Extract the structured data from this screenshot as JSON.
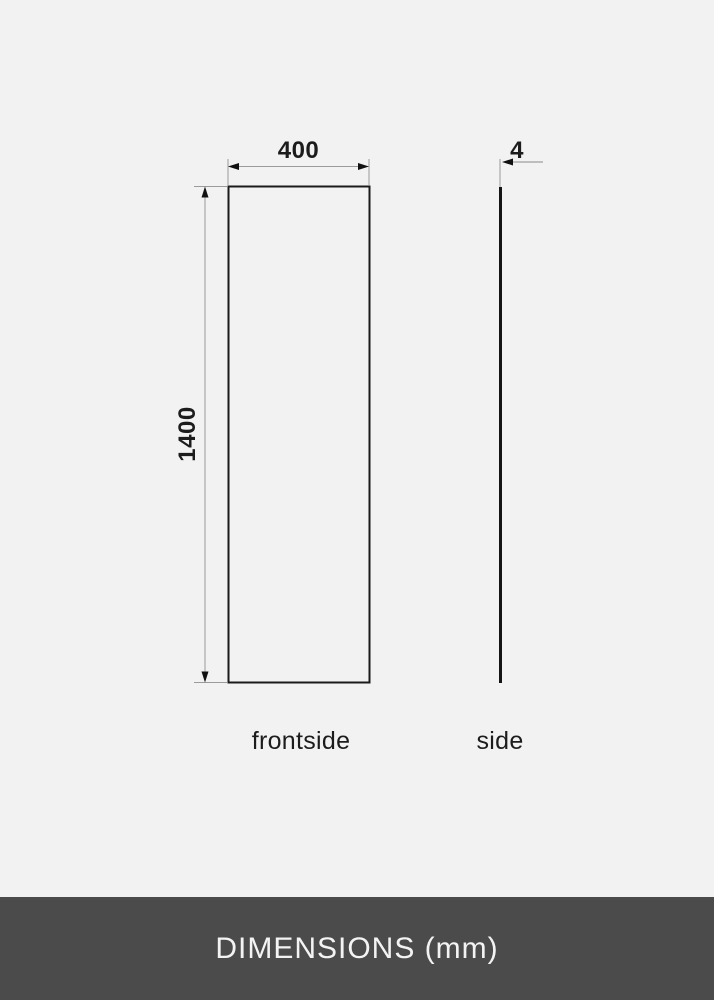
{
  "diagram": {
    "front_view": {
      "width_label": "400",
      "height_label": "1400",
      "caption": "frontside"
    },
    "side_view": {
      "thickness_label": "4",
      "caption": "side"
    }
  },
  "footer": {
    "title": "DIMENSIONS (mm)"
  },
  "colors": {
    "background": "#f2f2f2",
    "panel_outline": "#1a1a1a",
    "dimension_line": "#9b9b9b",
    "arrowhead": "#111111",
    "label_text": "#1c1c1c",
    "footer_background": "#4b4b4b",
    "footer_text": "#f3f3f3"
  }
}
